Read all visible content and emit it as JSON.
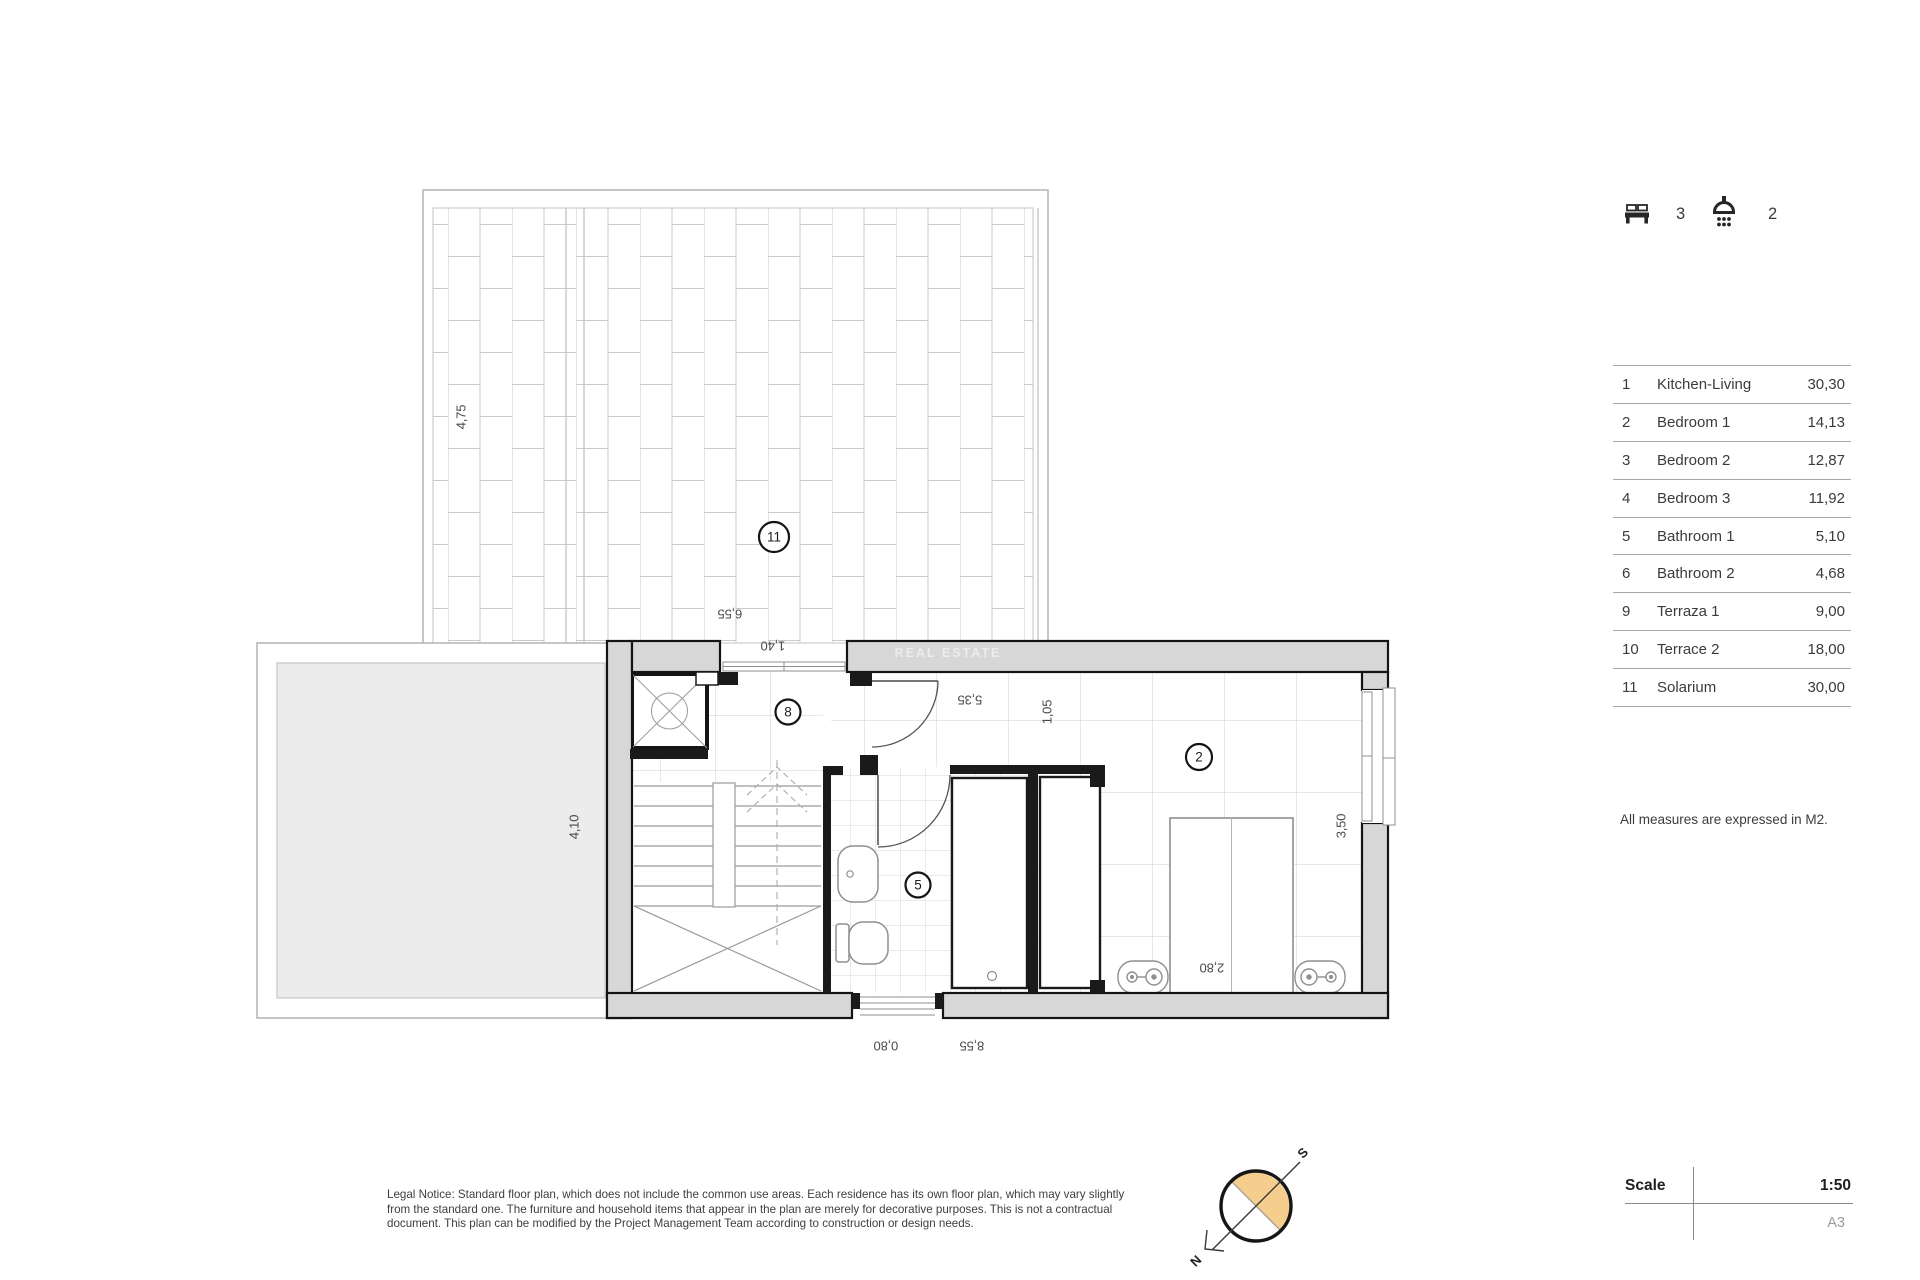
{
  "header": {
    "bedrooms": "3",
    "bathrooms": "2"
  },
  "legend": {
    "rows": [
      {
        "num": "1",
        "name": "Kitchen-Living",
        "area": "30,30"
      },
      {
        "num": "2",
        "name": "Bedroom 1",
        "area": "14,13"
      },
      {
        "num": "3",
        "name": "Bedroom 2",
        "area": "12,87"
      },
      {
        "num": "4",
        "name": "Bedroom 3",
        "area": "11,92"
      },
      {
        "num": "5",
        "name": "Bathroom 1",
        "area": "5,10"
      },
      {
        "num": "6",
        "name": "Bathroom 2",
        "area": "4,68"
      },
      {
        "num": "9",
        "name": "Terraza 1",
        "area": "9,00"
      },
      {
        "num": "10",
        "name": "Terrace 2",
        "area": "18,00"
      },
      {
        "num": "11",
        "name": "Solarium",
        "area": "30,00"
      }
    ],
    "note": "All measures are expressed in M2."
  },
  "titleblock": {
    "scale_label": "Scale",
    "scale_value": "1:50",
    "sheet": "A3"
  },
  "legal": {
    "line1": "Legal Notice: Standard floor plan, which does not include the common use areas. Each residence has its own floor plan, which may vary slightly",
    "line2": "from the standard one. The furniture and household items that appear in the plan are merely for decorative purposes. This is not a contractual",
    "line3": "document. This plan can be modified by the Project Management Team according to construction or design needs."
  },
  "compass": {
    "north": "N",
    "south": "S"
  },
  "plan": {
    "watermark": "REAL ESTATE",
    "room_labels": {
      "solarium": "11",
      "landing": "8",
      "bathroom": "5",
      "bedroom": "2"
    },
    "dims": {
      "solarium_height": "4,75",
      "solarium_width": "6,55",
      "opening_width": "1,40",
      "terrace_height": "4,10",
      "corridor_length": "5,35",
      "corridor_width": "1,05",
      "bedroom_width": "3,50",
      "bed_zone": "2,80",
      "window_width": "0,80",
      "total_width": "8,55"
    }
  },
  "colors": {
    "wall_fill": "#d7d7d7",
    "compass_accent": "#f5cd8c",
    "terrace_fill": "#ececec"
  }
}
